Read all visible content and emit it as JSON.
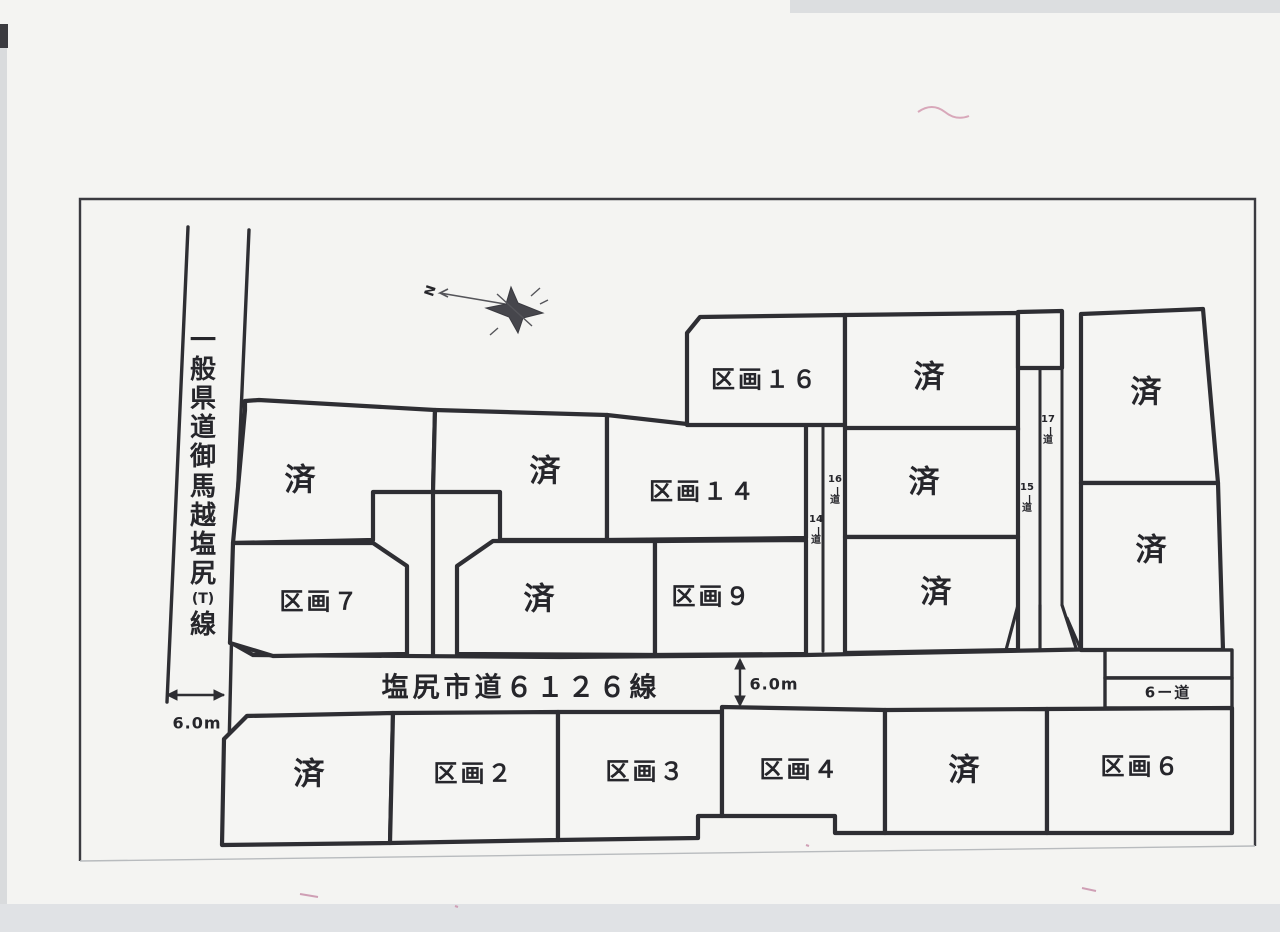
{
  "compass": {
    "north": "N"
  },
  "left_road": {
    "name": "一般県道御馬越塩尻(T)線",
    "width": "6.0m"
  },
  "main_road": {
    "name": "塩尻市道６１２６線",
    "width": "6.0m"
  },
  "lanes": {
    "lane_14": "14ー道",
    "lane_16": "16ー道",
    "lane_15": "15ー道",
    "lane_17": "17ー道",
    "lane_6": "6ー道"
  },
  "sold": {
    "label": "済"
  },
  "lots": {
    "lot_16": "区画１６",
    "lot_14": "区画１４",
    "lot_9": "区画９",
    "lot_7": "区画７",
    "lot_2": "区画２",
    "lot_3": "区画３",
    "lot_4": "区画４",
    "lot_6": "区画６"
  },
  "colors": {
    "line": "#2e2e33",
    "paper": "#f5f5f3",
    "artifact_pink": "#cf9fb5"
  }
}
